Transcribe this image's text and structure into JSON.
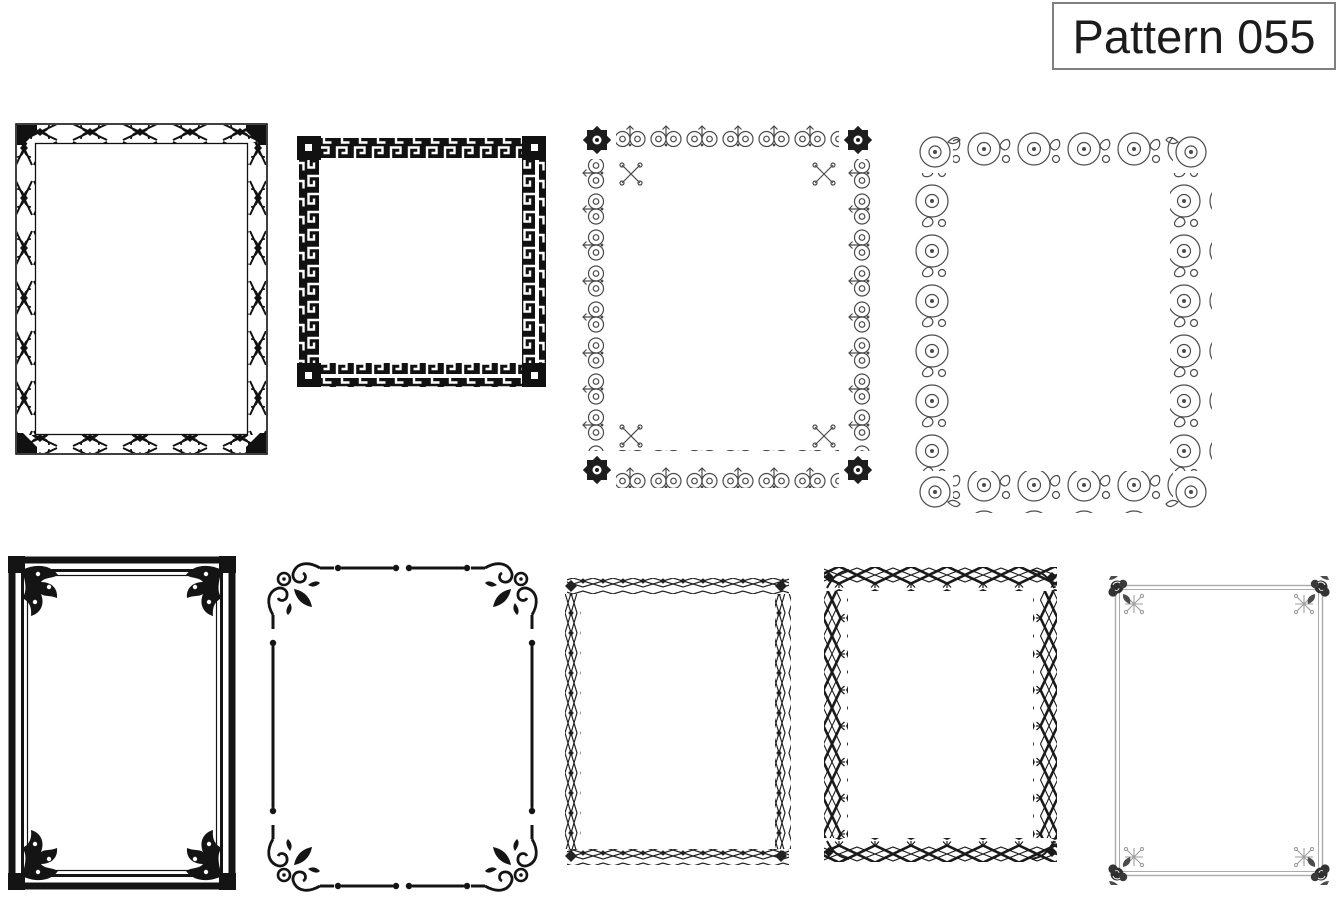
{
  "page": {
    "background_color": "#ffffff"
  },
  "title_box": {
    "label": "Pattern 055",
    "border_color": "#7f7f7f",
    "text_color": "#1c1c1c"
  },
  "frames": [
    {
      "id": "frame-1",
      "name": "arrow-cross-ornament-border",
      "description": "Rectangular border of repeating X-crosses and chevron ornaments between double rails, with solid arrow corners",
      "ink": "#111111"
    },
    {
      "id": "frame-2",
      "name": "greek-key-border",
      "description": "Square Greek key meander border band",
      "ink": "#111111"
    },
    {
      "id": "frame-3",
      "name": "scroll-fleur-outline-border",
      "description": "Outline border of paired curl scrolls with fleur stems, solid eight-point star rosettes and sprigs at the corners",
      "ink": "#4a4a4a"
    },
    {
      "id": "frame-4",
      "name": "wave-scroll-outline-border",
      "description": "Outline border of large wave C-scrolls with leaf curls",
      "ink": "#4a4a4a"
    },
    {
      "id": "frame-5",
      "name": "thick-flourish-corner-frame",
      "description": "Thick solid frame with double inner rules and solid leafy flourishes in each corner",
      "ink": "#141414"
    },
    {
      "id": "frame-6",
      "name": "corner-scroll-line-frame",
      "description": "Thin rule frame with dot-terminated broken sides and solid spiral-and-leaf corner flourishes",
      "ink": "#141414"
    },
    {
      "id": "frame-7",
      "name": "diamond-chain-border",
      "description": "Interlaced outline diamond chain border with small solid diamond accents",
      "ink": "#222222"
    },
    {
      "id": "frame-8",
      "name": "bold-diamond-border",
      "description": "Bold interlaced diamond border with inward sprig accents",
      "ink": "#1a1a1a"
    },
    {
      "id": "frame-9",
      "name": "gray-rule-rose-corner-frame",
      "description": "Thin gray double-rule frame with dark rose blossoms and gray sprigs at the corners",
      "ink": "#9e9e9e"
    }
  ]
}
